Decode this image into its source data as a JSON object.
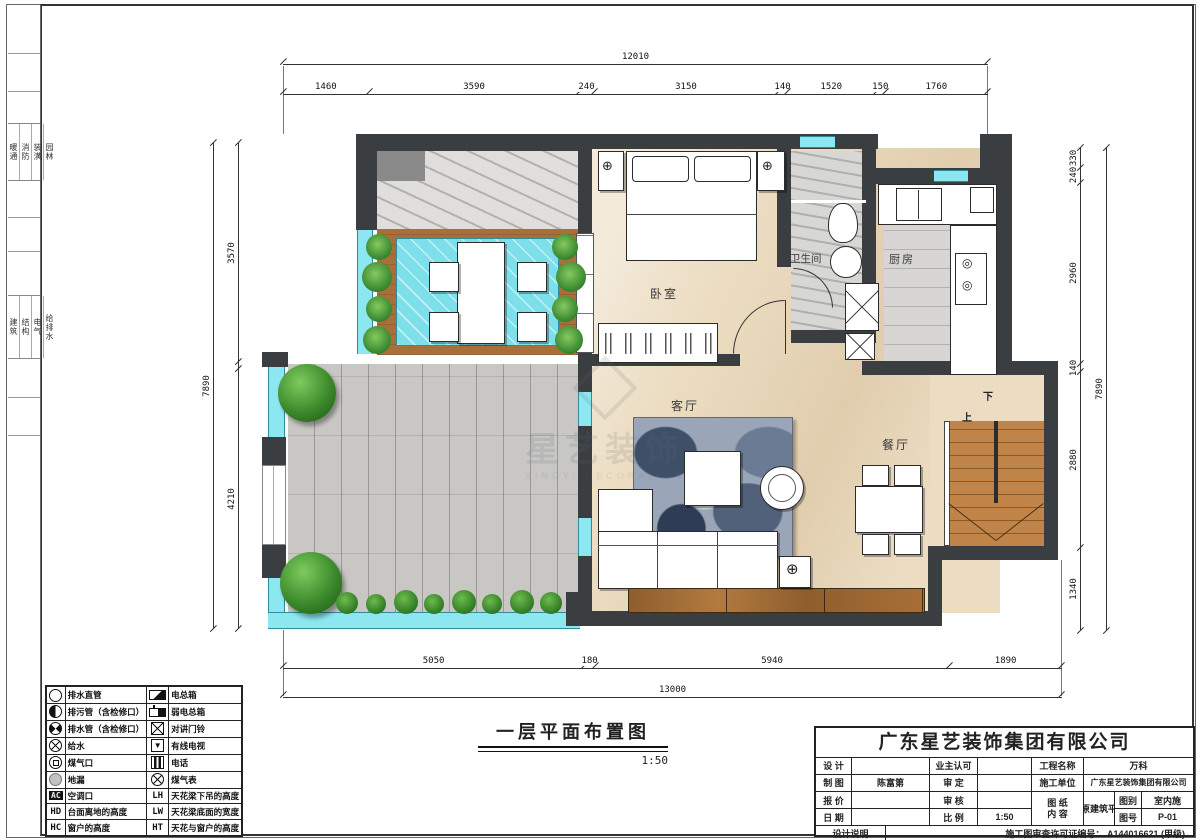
{
  "title": {
    "text": "一层平面布置图",
    "scale": "1:50"
  },
  "side_strip": {
    "g1": [
      "暖通",
      "消防",
      "装潢",
      "园林"
    ],
    "g2": [
      "建筑",
      "结构",
      "电气",
      "给排水"
    ]
  },
  "rooms": {
    "bedroom": "卧室",
    "bathroom": "卫生间",
    "kitchen": "厨房",
    "living": "客厅",
    "dining": "餐厅",
    "stair_up": "上",
    "stair_down": "下"
  },
  "watermark": {
    "cn": "星艺装饰",
    "en": "XINGYI DECORATION"
  },
  "dims": {
    "top": {
      "total": {
        "t": "12010",
        "v": 12010
      },
      "segments": [
        {
          "t": "1460",
          "v": 1460
        },
        {
          "t": "3590",
          "v": 3590
        },
        {
          "t": "240",
          "v": 240
        },
        {
          "t": "3150",
          "v": 3150
        },
        {
          "t": "140",
          "v": 140
        },
        {
          "t": "1520",
          "v": 1520
        },
        {
          "t": "150",
          "v": 150
        },
        {
          "t": "1760",
          "v": 1760
        }
      ]
    },
    "bottom": {
      "total": {
        "t": "13000",
        "v": 13000
      },
      "segments": [
        {
          "t": "5050",
          "v": 5050
        },
        {
          "t": "180",
          "v": 180
        },
        {
          "t": "5940",
          "v": 5940
        },
        {
          "t": "1890",
          "v": 1890
        }
      ]
    },
    "left": {
      "total": {
        "t": "7890",
        "v": 7890
      },
      "segments": [
        {
          "t": "3570",
          "v": 3570
        },
        {
          "t": "",
          "v": 110
        },
        {
          "t": "4210",
          "v": 4210
        }
      ]
    },
    "right": {
      "total": {
        "t": "7890",
        "v": 7890
      },
      "segments": [
        {
          "t": "330",
          "v": 330
        },
        {
          "t": "240",
          "v": 240
        },
        {
          "t": "2960",
          "v": 2960
        },
        {
          "t": "140",
          "v": 140
        },
        {
          "t": "2880",
          "v": 2880
        },
        {
          "t": "1340",
          "v": 1340
        }
      ]
    }
  },
  "legend": {
    "rows": [
      {
        "ls": "circle-open",
        "ll": "排水直管",
        "rs": "panel",
        "rl": "电总箱"
      },
      {
        "ls": "circle-half",
        "ll": "排污管（含检修口）",
        "rs": "panel-weak",
        "rl": "弱电总箱"
      },
      {
        "ls": "circle-quarters",
        "ll": "排水管（含检修口）",
        "rs": "box-x",
        "rl": "对讲门铃"
      },
      {
        "ls": "circle-x",
        "ll": "给水",
        "rs": "box-tv",
        "rl": "有线电视"
      },
      {
        "ls": "circle-box",
        "ll": "煤气口",
        "rs": "box-phone",
        "rl": "电话"
      },
      {
        "ls": "circle-gray",
        "ll": "地漏",
        "rs": "circle-gas",
        "rl": "煤气表"
      },
      {
        "ls": "badge-ac",
        "ll": "空调口",
        "rs": "badge-lh",
        "rl": "天花梁下吊的高度"
      },
      {
        "ls": "badge-hd",
        "ll": "台面离地的高度",
        "rs": "badge-lw",
        "rl": "天花梁底面的宽度"
      },
      {
        "ls": "badge-hc",
        "ll": "窗户的高度",
        "rs": "badge-ht",
        "rl": "天花与窗户的高度"
      }
    ]
  },
  "titleblock": {
    "company": "广东星艺装饰集团有限公司",
    "design_label": "设 计",
    "design_value": "",
    "owner_label": "业主认可",
    "owner_value": "",
    "project_label": "工程名称",
    "project_value": "万科",
    "draft_label": "制 图",
    "draft_value": "陈富第",
    "approve_label": "审 定",
    "approve_value": "",
    "contractor_label": "施工单位",
    "contractor_value": "广东星艺装饰集团有限公司",
    "quote_label": "报 价",
    "quote_value": "",
    "review_label": "审 核",
    "review_value": "",
    "date_label": "日 期",
    "date_value": "",
    "scale_label": "比 例",
    "scale_value": "1:50",
    "sheet_label": "图 纸",
    "content_label": "内 容",
    "sheet_value": "一层原建筑平面图",
    "category_label": "图别",
    "category_value": "室内施",
    "number_label": "图号",
    "number_value": "P-01",
    "notes_label": "设计说明",
    "permit_label": "施工图审查许可证编号：",
    "permit_value": "A144016621 (甲级)"
  },
  "colors": {
    "wall": "#3a3e41",
    "water": "#8ce7f0",
    "wood": "#a96f3a",
    "beige_floor": "#ecddc2",
    "stone": "#b5b4b0",
    "green": "#3f8f35"
  }
}
